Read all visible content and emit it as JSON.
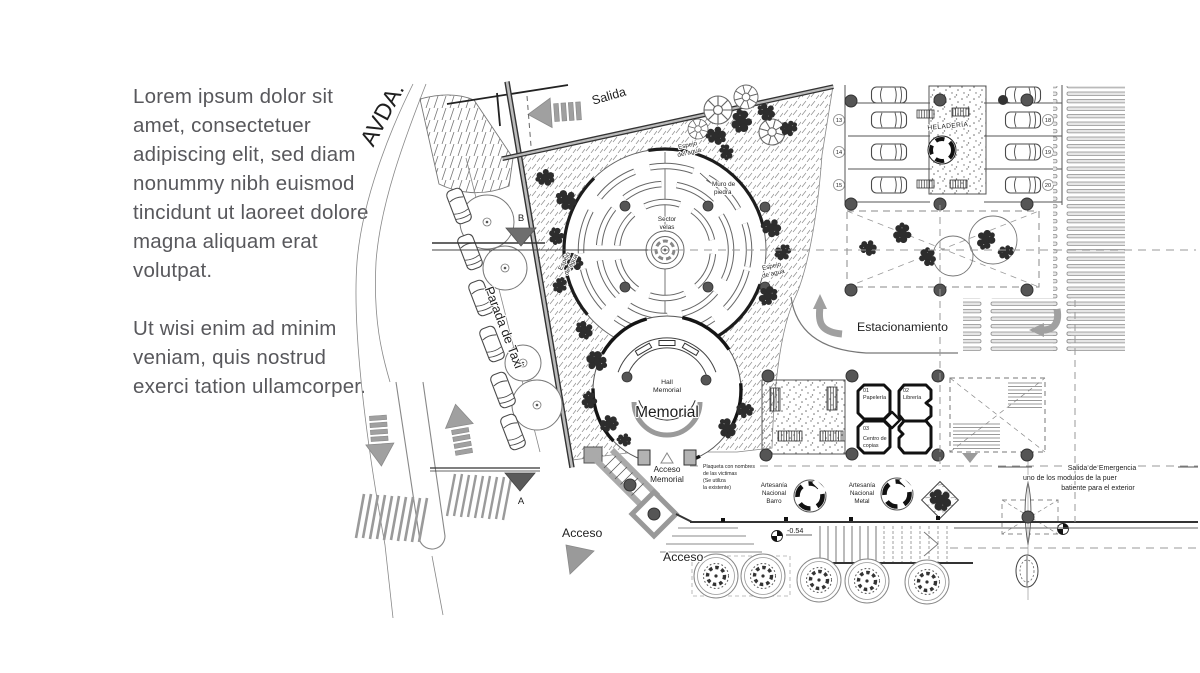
{
  "intro": {
    "p1": "Lorem ipsum dolor sit amet, consectetuer adipiscing elit, sed diam nonummy nibh euismod tincidunt ut laoreet dolore magna aliquam erat volutpat.",
    "p2": "Ut wisi enim ad minim veniam, quis nostrud exerci tation ullamcorper."
  },
  "plan": {
    "avenue": "AVDA.",
    "salida": "Salida",
    "parada_taxi": "Parada de Taxi",
    "acceso_left": "Acceso",
    "acceso_center": "Acceso",
    "estacionamiento": "Estacionamiento",
    "heladeria": "HELADERÍA",
    "memorial": {
      "hall1": "Hall",
      "hall2": "Memorial",
      "name": "Memorial",
      "acceso1": "Acceso",
      "acceso2": "Memorial",
      "sector1": "Sector",
      "sector2": "velas",
      "muro1": "Muro de",
      "muro2": "piedra"
    },
    "espejo": {
      "top1": "Espejo",
      "top2": "del agua",
      "left1": "Espejo",
      "left2": "de agua",
      "right1": "Espejo",
      "right2": "de agua"
    },
    "plaqueta": [
      "Plaqueta con nombres",
      "de las victimas",
      "(Se utiliza",
      "la existente)"
    ],
    "emergencia": [
      "Salida de Emergencia",
      "uno de los modulos de la puer",
      "batiente para el exterior"
    ],
    "kiosks": {
      "k1num": "01",
      "k1": "Papelería",
      "k2num": "02",
      "k2": "Librería",
      "k3num": "03",
      "k3a": "Centro de",
      "k3b": "copias"
    },
    "artesania": {
      "a1": "Artesanía",
      "a2": "Nacional",
      "a3": "Barro",
      "b1": "Artesanía",
      "b2": "Nacional",
      "b3": "Metal"
    },
    "stalls": {
      "left": [
        "13",
        "14",
        "15"
      ],
      "right": [
        "18",
        "19",
        "20"
      ]
    },
    "markers": {
      "a": "A",
      "b": "B",
      "level": "-0.54"
    },
    "accent_gray": "#9a9a9a"
  }
}
